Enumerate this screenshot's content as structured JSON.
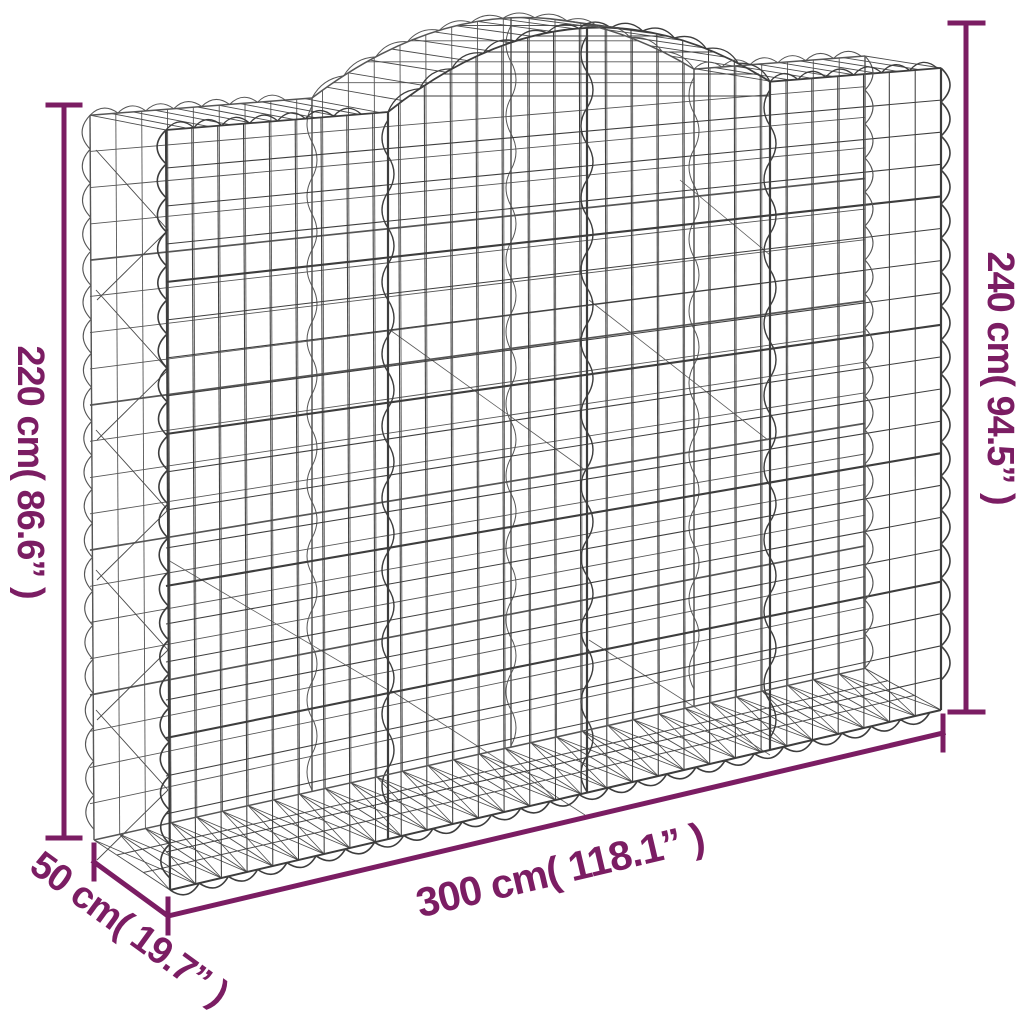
{
  "diagram": {
    "subject": "arched gabion wire mesh basket dimension diagram"
  },
  "dimensions": {
    "side_height": {
      "label": "220 cm( 86.6” )",
      "value_cm": 220,
      "value_in": 86.6
    },
    "total_height": {
      "label": "240 cm( 94.5” )",
      "value_cm": 240,
      "value_in": 94.5
    },
    "width": {
      "label": "300 cm( 118.1” )",
      "value_cm": 300,
      "value_in": 118.1
    },
    "depth": {
      "label": "50 cm( 19.7” )",
      "value_cm": 50,
      "value_in": 19.7
    }
  },
  "colors": {
    "dimension_annotation": "#7b1d63",
    "wire": "#3d3d3d",
    "wire_back": "#565656",
    "wire_mid": "#4a4a4a",
    "background": "#ffffff"
  }
}
